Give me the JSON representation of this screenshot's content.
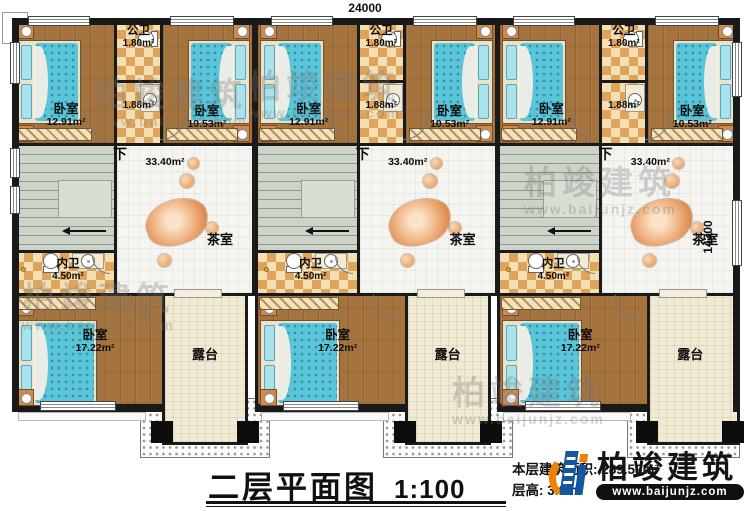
{
  "dimensions": {
    "top": "24000",
    "right": "14300"
  },
  "title": {
    "main": "二层平面图",
    "scale": "1:100",
    "area_label": "本层建筑面积: 289.59m²",
    "floor_height_label": "层高: 3.6m"
  },
  "logo": {
    "name": "柏竣建筑",
    "url": "www.baijunjz.com"
  },
  "watermark": {
    "text": "柏竣建筑",
    "url": "www.baijunjz.com"
  },
  "units": [
    {
      "bedroomA": {
        "label": "卧室",
        "area": "12.91m²"
      },
      "publicBath": {
        "label": "公卫",
        "area": "1.80m²"
      },
      "washroom": {
        "area": "1.88m²"
      },
      "bedroomB": {
        "label": "卧室",
        "area": "10.53m²"
      },
      "stairs": {
        "label": "下"
      },
      "teaRoom": {
        "label": "茶室",
        "area": "33.40m²"
      },
      "innerBath": {
        "label": "内卫",
        "area": "4.50m²"
      },
      "bedroomC": {
        "label": "卧室",
        "area": "17.22m²"
      },
      "terrace": {
        "label": "露台"
      }
    },
    {
      "bedroomA": {
        "label": "卧室",
        "area": "12.91m²"
      },
      "publicBath": {
        "label": "公卫",
        "area": "1.80m²"
      },
      "washroom": {
        "area": "1.88m²"
      },
      "bedroomB": {
        "label": "卧室",
        "area": "10.53m²"
      },
      "stairs": {
        "label": "下"
      },
      "teaRoom": {
        "label": "茶室",
        "area": "33.40m²"
      },
      "innerBath": {
        "label": "内卫",
        "area": "4.50m²"
      },
      "bedroomC": {
        "label": "卧室",
        "area": "17.22m²"
      },
      "terrace": {
        "label": "露台"
      }
    },
    {
      "bedroomA": {
        "label": "卧室",
        "area": "12.91m²"
      },
      "publicBath": {
        "label": "公卫",
        "area": "1.80m²"
      },
      "washroom": {
        "area": "1.88m²"
      },
      "bedroomB": {
        "label": "卧室",
        "area": "10.53m²"
      },
      "stairs": {
        "label": "下"
      },
      "teaRoom": {
        "label": "茶室",
        "area": "33.40m²"
      },
      "innerBath": {
        "label": "内卫",
        "area": "4.50m²"
      },
      "bedroomC": {
        "label": "卧室",
        "area": "17.22m²"
      },
      "terrace": {
        "label": "露台"
      }
    }
  ]
}
